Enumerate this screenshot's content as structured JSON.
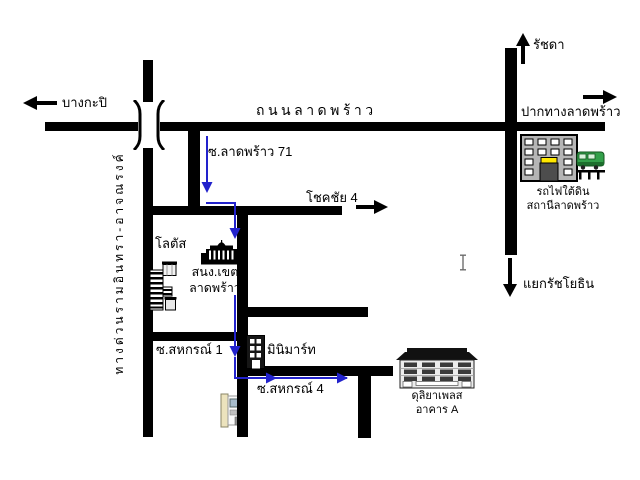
{
  "colors": {
    "background": "#ffffff",
    "road": "#000000",
    "route_arrow": "#2222cc",
    "train_green": "#33a04a",
    "station_building_gray": "#b5b5b5",
    "highlight_window_yellow": "#ffe800"
  },
  "labels": {
    "bangkapi": "บางกะปิ",
    "thanon_ladprao": "ถนนลาดพร้าว",
    "ratchada": "รัชดา",
    "pak_thang_ladprao": "ปากทางลาดพร้าว",
    "soi_ladprao_71": "ซ.ลาดพร้าว 71",
    "chokchai_4": "โชคชัย 4",
    "lotus": "โลตัส",
    "district_office_line1": "สนง.เขต",
    "district_office_line2": "ลาดพร้าว",
    "mrt_line1": "รถไฟใต้ดิน",
    "mrt_line2": "สถานีลาดพร้าว",
    "yaek_ratchayothin": "แยกรัชโยธิน",
    "soi_sahakorn_1": "ซ.สหกรณ์ 1",
    "minimart": "มินิมาร์ท",
    "soi_sahakorn_4": "ซ.สหกรณ์ 4",
    "duliya_line1": "ดุลิยาเพลส",
    "duliya_line2": "อาคาร A",
    "expressway": "ทางด่วนรามอินทรา-อาจณรงค์"
  },
  "icons": {
    "bangkapi_arrow": "left-arrow",
    "pak_thang_arrow": "right-arrow",
    "ratchada_arrow": "up-arrow",
    "chokchai_arrow": "right-arrow",
    "ratchayothin_arrow": "down-arrow",
    "overpass": "expressway-bridge-brackets",
    "route": "blue-route-arrows",
    "buildings": [
      "mrt-station-building",
      "mrt-train",
      "district-office-building",
      "lotus-store",
      "minimart-shop",
      "corner-shop",
      "duliya-place-building"
    ],
    "cursor": "text-ibeam-cursor"
  }
}
